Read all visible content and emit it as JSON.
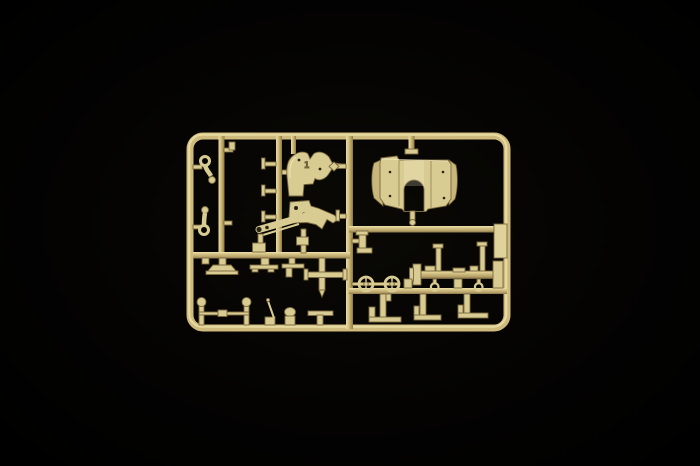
{
  "image": {
    "type": "product-photo",
    "subject": "Tan injection-molded model kit sprue (parts tree) with gun-carriage components, centered on a black background",
    "molded_marking": "1",
    "colors": {
      "background": "#020202",
      "plastic_base": "#cdba7c",
      "plastic_highlight": "#ece0a8",
      "plastic_shadow": "#6e5d38",
      "part_fill": "#d9cc92",
      "part_shade": "#c9b67a",
      "part_outline": "#7a683e",
      "marking_color": "#5f5030"
    },
    "parts": [
      {
        "name": "outer sprue frame",
        "location": "perimeter"
      },
      {
        "name": "small pivot links (2)",
        "location": "left column"
      },
      {
        "name": "gun cradle upper bracket",
        "location": "upper center"
      },
      {
        "name": "gun cradle lower bracket",
        "location": "center"
      },
      {
        "name": "elevation arm with holes",
        "location": "center left"
      },
      {
        "name": "gun shield / mount bracket with U-notch",
        "location": "upper right"
      },
      {
        "name": "flat side plate",
        "location": "right edge"
      },
      {
        "name": "mounting feet (3)",
        "location": "lower left runner"
      },
      {
        "name": "cross-shaped stake",
        "location": "lower center"
      },
      {
        "name": "tow bar with ball ends",
        "location": "bottom left"
      },
      {
        "name": "hand lever",
        "location": "bottom center"
      },
      {
        "name": "T-handle",
        "location": "bottom center"
      },
      {
        "name": "spoked road wheels (2)",
        "location": "lower right"
      },
      {
        "name": "axle beam with posts",
        "location": "lower right"
      },
      {
        "name": "ring pins (2)",
        "location": "lower right"
      },
      {
        "name": "step brackets (3)",
        "location": "bottom right"
      },
      {
        "name": "elbow bracket",
        "location": "right of center divider"
      }
    ]
  }
}
